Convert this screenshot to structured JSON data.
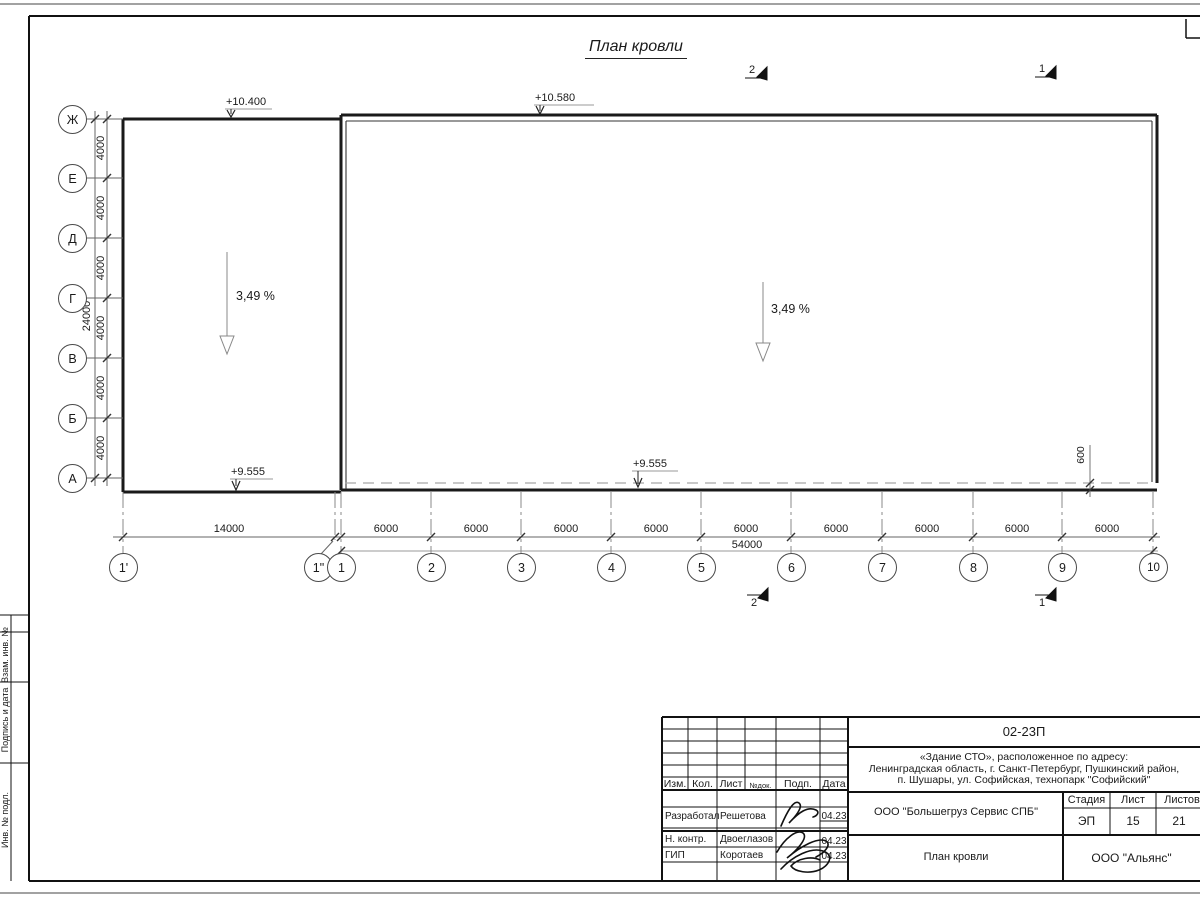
{
  "title": "План кровли",
  "annotations": {
    "slope_left": "3,49 %",
    "slope_right": "3,49 %",
    "elev_left_top": "+10.400",
    "elev_main_top": "+10.580",
    "elev_left_bottom": "+9.555",
    "elev_main_bottom": "+9.555"
  },
  "sections": {
    "top_2": "2",
    "top_1": "1",
    "bottom_2": "2",
    "bottom_1": "1"
  },
  "axes": {
    "left": [
      "Ж",
      "Е",
      "Д",
      "Г",
      "В",
      "Б",
      "А"
    ],
    "bottom": [
      "1'",
      "1\"",
      "1",
      "2",
      "3",
      "4",
      "5",
      "6",
      "7",
      "8",
      "9",
      "10"
    ]
  },
  "dims": {
    "v_segments": [
      "4000",
      "4000",
      "4000",
      "4000",
      "4000",
      "4000"
    ],
    "v_total": "24000",
    "h_segments": [
      "14000",
      "6000",
      "6000",
      "6000",
      "6000",
      "6000",
      "6000",
      "6000",
      "6000",
      "6000"
    ],
    "h_total": "54000",
    "offset_600": "600"
  },
  "margin_stamp": {
    "labels": [
      "Взам. инв. №",
      "Подпись и дата",
      "Инв. № подл."
    ]
  },
  "title_block": {
    "doc_number": "02-23П",
    "project_lines": [
      "«Здание СТО», расположенное по адресу:",
      "Ленинградская область, г. Санкт-Петербург, Пушкинский район,",
      "п. Шушары, ул. Софийская, технопарк \"Софийский\""
    ],
    "header_cols": [
      "Изм.",
      "Кол.",
      "Лист",
      "№док.",
      "Подп.",
      "Дата"
    ],
    "rows": [
      {
        "role": "Разработал",
        "name": "Решетова",
        "date": "04.23"
      },
      {
        "role": "Н. контр.",
        "name": "Двоеглазов",
        "date": "04.23"
      },
      {
        "role": "ГИП",
        "name": "Коротаев",
        "date": "04.23"
      }
    ],
    "company": "ООО \"Большегруз Сервис СПБ\"",
    "sheet_title": "План кровли",
    "stage_label": "Стадия",
    "sheet_label": "Лист",
    "sheets_label": "Листов",
    "stage": "ЭП",
    "sheet": "15",
    "sheets": "21",
    "org": "ООО \"Альянс\""
  }
}
